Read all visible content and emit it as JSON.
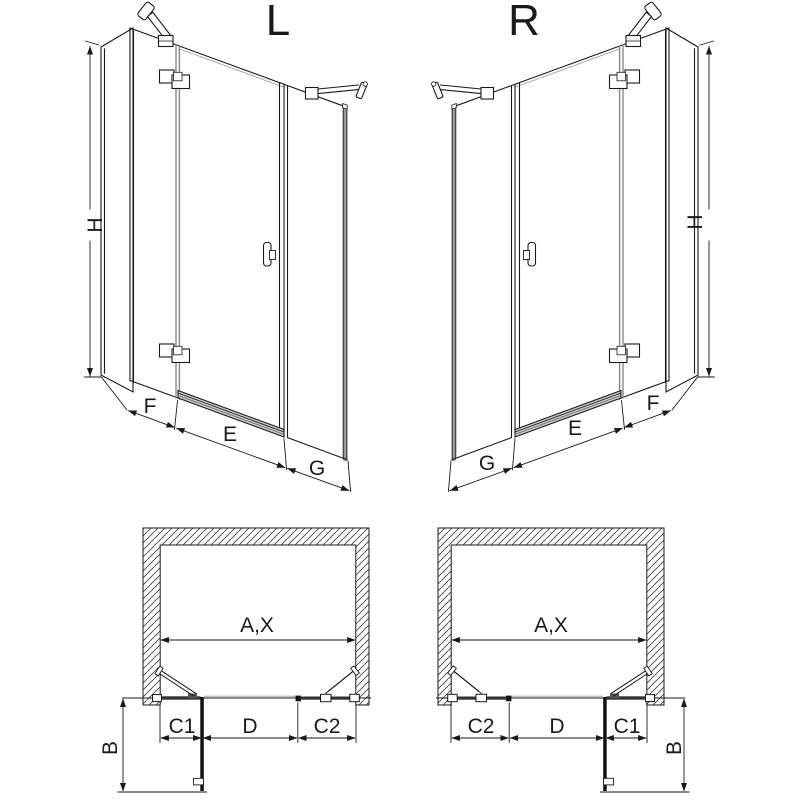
{
  "drawing": {
    "kind": "shower-enclosure-technical-diagram",
    "colors": {
      "line": "#1a1a1a",
      "profile_gray": "#888888",
      "panel_dark": "#333333",
      "hatch": "#444444",
      "background": "#ffffff"
    },
    "views": {
      "iso_left": {
        "title": "L",
        "height_label": "H",
        "fixed_panel_near_wall": "F",
        "door_panel": "E",
        "fixed_panel_far": "G"
      },
      "iso_right": {
        "title": "R",
        "height_label": "H",
        "fixed_panel_far": "G",
        "door_panel": "E",
        "fixed_panel_near_wall": "F"
      },
      "plan_left": {
        "opening_width": "A,X",
        "side_panel_depth": "B",
        "segment_hinge_side": "C1",
        "segment_door": "D",
        "segment_far_side": "C2"
      },
      "plan_right": {
        "opening_width": "A,X",
        "side_panel_depth": "B",
        "segment_far_side": "C2",
        "segment_door": "D",
        "segment_hinge_side": "C1"
      }
    }
  }
}
